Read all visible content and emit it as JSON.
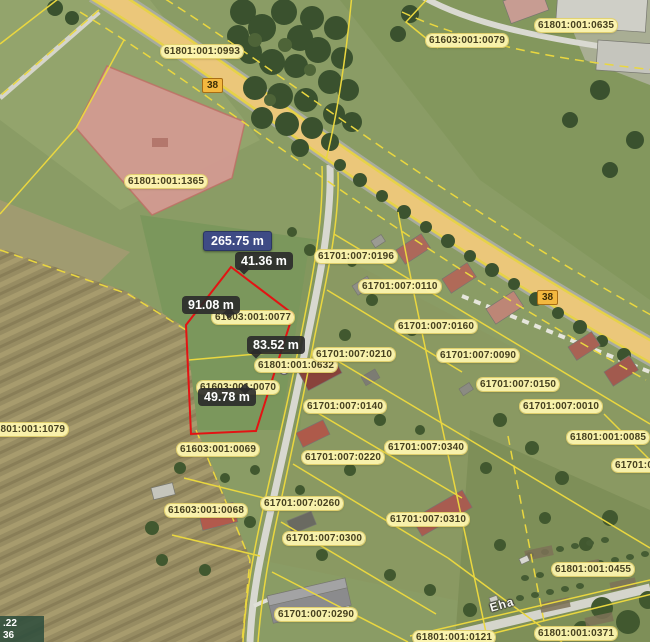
{
  "map": {
    "road_number": "38",
    "street_name": "Eha",
    "parcel_labels": [
      "61801:001:0993",
      "61603:001:0079",
      "61801:001:0635",
      "61801:001:1365",
      "61603:001:0077",
      "61801:001:0632",
      "61603:001:0070",
      "61701:007:0196",
      "61701:007:0110",
      "61701:007:0160",
      "61701:007:0210",
      "61701:007:0090",
      "61701:007:0150",
      "61701:007:0010",
      "61701:007:0140",
      "61801:001:0085",
      "61701:00",
      "61801:001:1079",
      "61603:001:0069",
      "61701:007:0340",
      "61701:007:0220",
      "61603:001:0068",
      "61701:007:0260",
      "61701:007:0310",
      "61701:007:0300",
      "61801:001:0455",
      "61701:007:0290",
      "61801:001:0371",
      "61801:001:0121"
    ]
  },
  "measurement": {
    "total": "265.75 m",
    "segments": [
      "41.36 m",
      "91.08 m",
      "83.52 m",
      "49.78 m"
    ]
  },
  "coords": {
    "line1": ".22",
    "line2": "36"
  },
  "colors": {
    "parcel_line": "#ead540",
    "selection_line": "#e31313",
    "label_bg": "#fdf5af",
    "total_bg": "#3e4b85",
    "road_fill": "#ebc77a"
  }
}
